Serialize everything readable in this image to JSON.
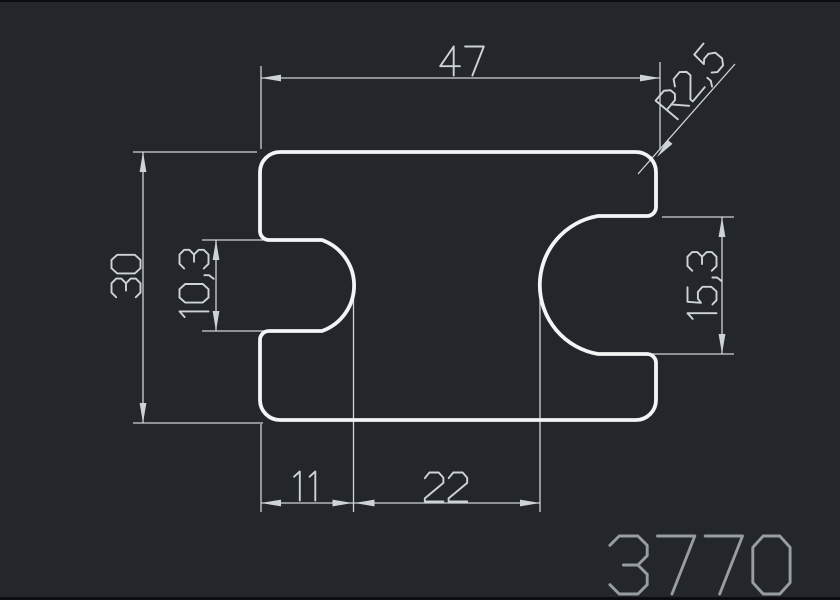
{
  "window": {
    "background": "#23272b",
    "top_border_color": "#0b0d10",
    "bottom_border_color": "#0b0d10"
  },
  "colors": {
    "profile_outline": "#f2f4f6",
    "dimension_lines": "#ced3d7",
    "part_number_text": "#979da3"
  },
  "drawing": {
    "part_number": "3770",
    "dimensions": [
      {
        "id": "dim-width-top",
        "label": "47"
      },
      {
        "id": "dim-height-left",
        "label": "30"
      },
      {
        "id": "dim-left-notch",
        "label": "10,3"
      },
      {
        "id": "dim-right-notch",
        "label": "15,3"
      },
      {
        "id": "dim-bottom-left",
        "label": "11"
      },
      {
        "id": "dim-bottom-middle",
        "label": "22"
      },
      {
        "id": "dim-corner-radius",
        "label": "R2,5"
      }
    ]
  }
}
